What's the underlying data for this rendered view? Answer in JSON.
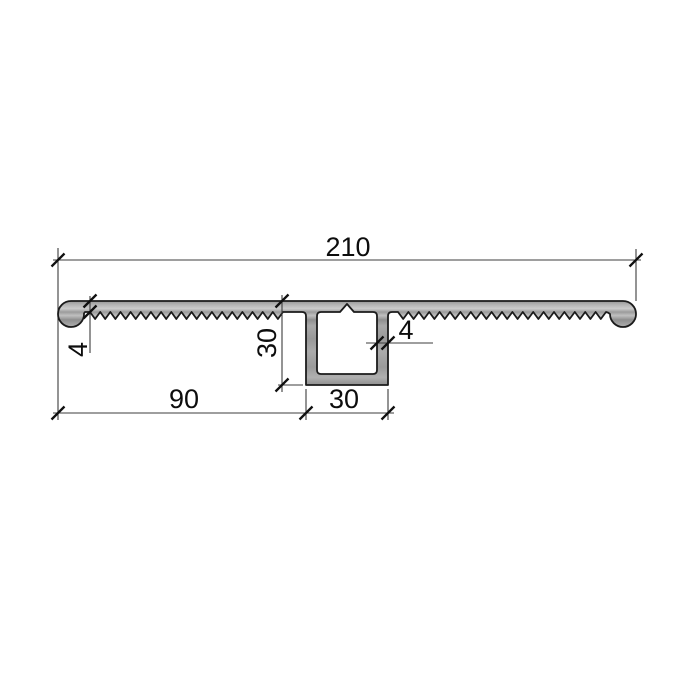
{
  "drawing": {
    "kind": "aluminium-profile-cross-section",
    "background_color": "#ffffff",
    "outline_color": "#1b1b1b",
    "metal_fill_color": "#a1a1a1",
    "dimension_text_color": "#0d0d0d",
    "dimensions": {
      "total_width": "210",
      "left_plate_thickness": "4",
      "box_height": "30",
      "wall_thickness": "4",
      "left_offset": "90",
      "box_width": "30"
    }
  }
}
